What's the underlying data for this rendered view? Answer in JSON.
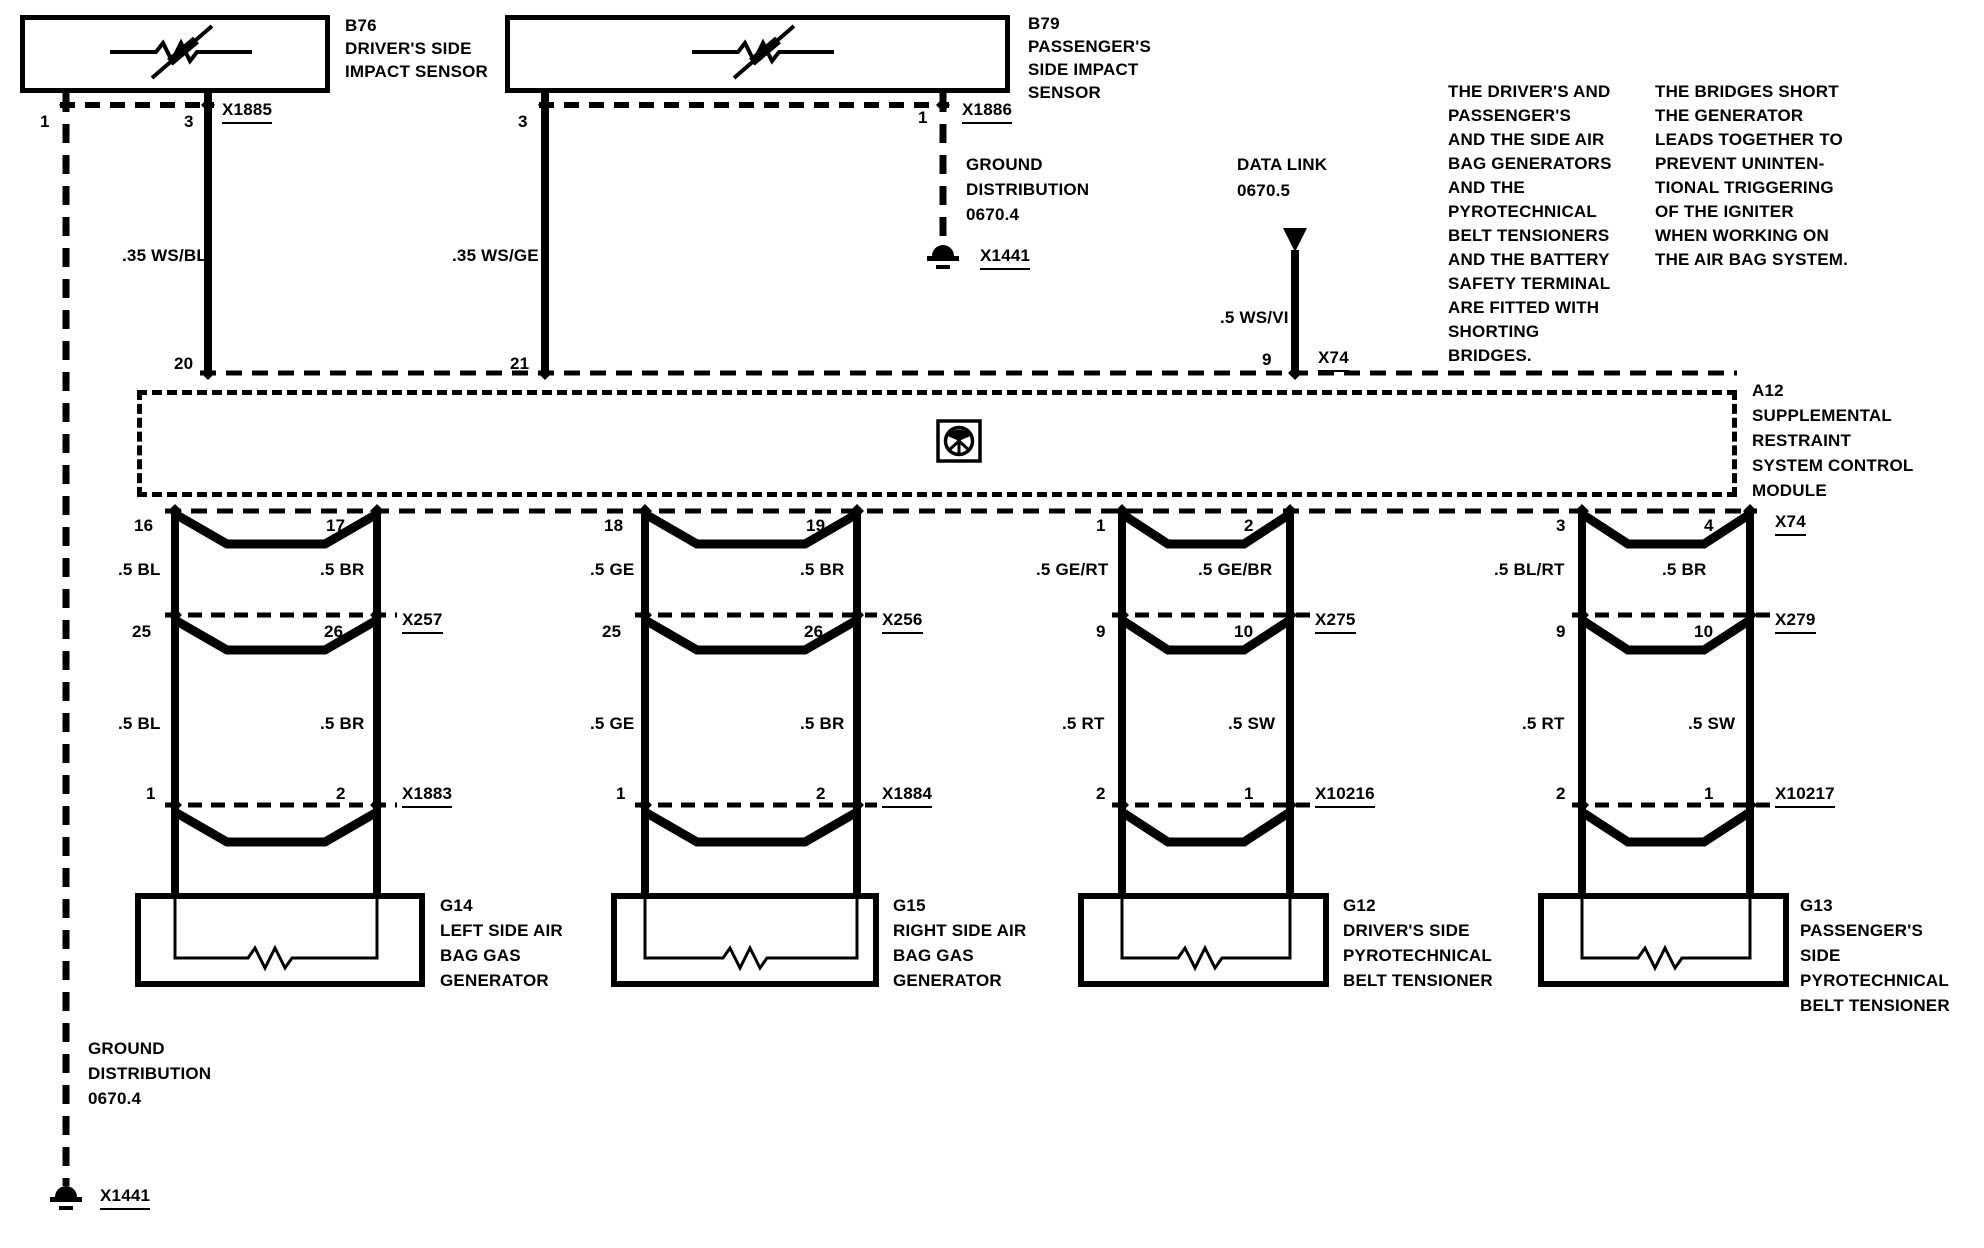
{
  "colors": {
    "ink": "#000000",
    "paper": "#ffffff"
  },
  "sensors": {
    "b76": {
      "label": [
        "B76",
        "DRIVER'S SIDE",
        "IMPACT SENSOR"
      ],
      "pin_left": "1",
      "pin_right": "3",
      "connector": "X1885",
      "wire": ".35 WS/BL",
      "module_pin": "20"
    },
    "b79": {
      "label": [
        "B79",
        "PASSENGER'S",
        "SIDE IMPACT",
        "SENSOR"
      ],
      "pin_left": "3",
      "pin_right": "1",
      "connector": "X1886",
      "wire": ".35 WS/GE",
      "module_pin": "21"
    }
  },
  "ground_top": {
    "label": [
      "GROUND",
      "DISTRIBUTION",
      "0670.4"
    ],
    "connector": "X1441"
  },
  "ground_bottom": {
    "label": [
      "GROUND",
      "DISTRIBUTION",
      "0670.4"
    ],
    "connector": "X1441"
  },
  "data_link": {
    "label": [
      "DATA LINK",
      "0670.5"
    ],
    "wire": ".5 WS/VI",
    "module_pin": "9",
    "connector": "X74"
  },
  "module": {
    "label": [
      "A12",
      "SUPPLEMENTAL",
      "RESTRAINT",
      "SYSTEM CONTROL",
      "MODULE"
    ],
    "bottom_connector": "X74"
  },
  "notes": {
    "shorting_bridges": [
      "THE DRIVER'S AND",
      "PASSENGER'S",
      "AND THE SIDE AIR",
      "BAG GENERATORS",
      "AND THE",
      "PYROTECHNICAL",
      "BELT TENSIONERS",
      "AND THE BATTERY",
      "SAFETY TERMINAL",
      "ARE FITTED WITH",
      "SHORTING",
      "BRIDGES."
    ],
    "bridges_short": [
      "THE BRIDGES SHORT",
      "THE GENERATOR",
      "LEADS TOGETHER TO",
      "PREVENT UNINTEN-",
      "TIONAL TRIGGERING",
      "OF THE IGNITER",
      "WHEN WORKING ON",
      "THE AIR BAG SYSTEM."
    ]
  },
  "branches": [
    {
      "pin_l": "16",
      "pin_r": "17",
      "wire1_l": ".5 BL",
      "wire1_r": ".5 BR",
      "mid_pin_l": "25",
      "mid_pin_r": "26",
      "mid_connector": "X257",
      "wire2_l": ".5 BL",
      "wire2_r": ".5 BR",
      "low_pin_l": "1",
      "low_pin_r": "2",
      "low_connector": "X1883",
      "device": [
        "G14",
        "LEFT SIDE AIR",
        "BAG GAS",
        "GENERATOR"
      ]
    },
    {
      "pin_l": "18",
      "pin_r": "19",
      "wire1_l": ".5 GE",
      "wire1_r": ".5 BR",
      "mid_pin_l": "25",
      "mid_pin_r": "26",
      "mid_connector": "X256",
      "wire2_l": ".5 GE",
      "wire2_r": ".5 BR",
      "low_pin_l": "1",
      "low_pin_r": "2",
      "low_connector": "X1884",
      "device": [
        "G15",
        "RIGHT SIDE AIR",
        "BAG GAS",
        "GENERATOR"
      ]
    },
    {
      "pin_l": "1",
      "pin_r": "2",
      "wire1_l": ".5 GE/RT",
      "wire1_r": ".5 GE/BR",
      "mid_pin_l": "9",
      "mid_pin_r": "10",
      "mid_connector": "X275",
      "wire2_l": ".5 RT",
      "wire2_r": ".5 SW",
      "low_pin_l": "2",
      "low_pin_r": "1",
      "low_connector": "X10216",
      "device": [
        "G12",
        "DRIVER'S SIDE",
        "PYROTECHNICAL",
        "BELT TENSIONER"
      ]
    },
    {
      "pin_l": "3",
      "pin_r": "4",
      "top_connector": "X74",
      "wire1_l": ".5 BL/RT",
      "wire1_r": ".5 BR",
      "mid_pin_l": "9",
      "mid_pin_r": "10",
      "mid_connector": "X279",
      "wire2_l": ".5 RT",
      "wire2_r": ".5 SW",
      "low_pin_l": "2",
      "low_pin_r": "1",
      "low_connector": "X10217",
      "device": [
        "G13",
        "PASSENGER'S",
        "SIDE",
        "PYROTECHNICAL",
        "BELT TENSIONER"
      ]
    }
  ]
}
